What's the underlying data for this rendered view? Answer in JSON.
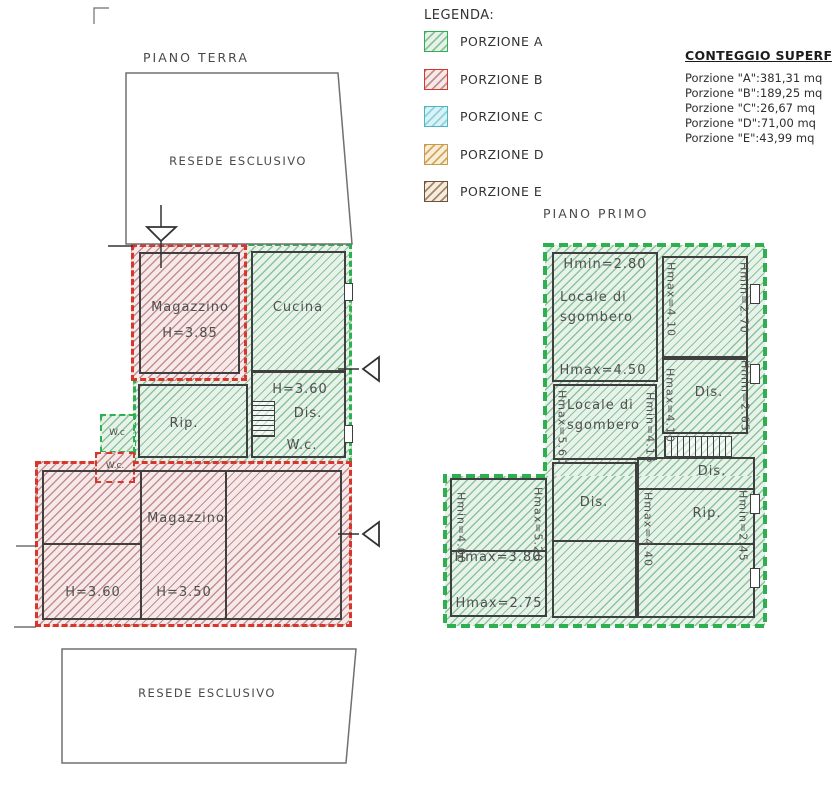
{
  "legend": {
    "title": "LEGENDA:",
    "items": [
      {
        "label": "PORZIONE A",
        "fill": "#e7f3ea",
        "line": "#8cc39a",
        "border": "#2eb050"
      },
      {
        "label": "PORZIONE B",
        "fill": "#f7e9e9",
        "line": "#c28f8f",
        "border": "#d8352b"
      },
      {
        "label": "PORZIONE C",
        "fill": "#daf2f5",
        "line": "#8fd2dc",
        "border": "#49b6c6"
      },
      {
        "label": "PORZIONE D",
        "fill": "#f7edd8",
        "line": "#d3a85c",
        "border": "#c79b4b"
      },
      {
        "label": "PORZIONE E",
        "fill": "#f2ece3",
        "line": "#a8875f",
        "border": "#6e5138"
      }
    ]
  },
  "surfaces": {
    "title": "CONTEGGIO SUPERFICI:",
    "rows": [
      {
        "label": "Porzione \"A\":",
        "value": "381,31 mq"
      },
      {
        "label": "Porzione \"B\":",
        "value": "189,25 mq"
      },
      {
        "label": "Porzione \"C\":",
        "value": "26,67 mq"
      },
      {
        "label": "Porzione \"D\":",
        "value": "71,00 mq"
      },
      {
        "label": "Porzione \"E\":",
        "value": "43,99 mq"
      }
    ]
  },
  "ground_floor": {
    "title": "PIANO TERRA",
    "resede_top": "RESEDE ESCLUSIVO",
    "resede_bottom": "RESEDE ESCLUSIVO",
    "magazzino_top_name": "Magazzino",
    "magazzino_top_h": "H=3.85",
    "cucina": "Cucina",
    "hall_h": "H=3.60",
    "hall_dis": "Dis.",
    "hall_wc": "W.c.",
    "rip": "Rip.",
    "wc_green": "W.c",
    "wc_red": "W.c.",
    "magazzino_bottom": "Magazzino",
    "room_h360": "H=3.60",
    "room_h350": "H=3.50"
  },
  "first_floor": {
    "title": "PIANO PRIMO",
    "locale1_hmin": "Hmin=2.80",
    "locale1_name": "Locale di sgombero",
    "locale1_hmax": "Hmax=4.50",
    "room_ne_left": "Hmax=4.10",
    "room_ne_right": "Hmin=2.70",
    "dis1": "Dis.",
    "dis1_left": "Hmax=4.10",
    "dis1_right": "Hmin=2.65",
    "locale2_name": "Locale di sgombero",
    "locale2_left": "Hmax=5.60",
    "locale2_right": "Hmin=4.15",
    "dis2": "Dis.",
    "rip": "Rip.",
    "rip_left": "Hmax=4.40",
    "rip_right": "Hmin=2.45",
    "sw_left": "Hmin=4.00",
    "sw_right": "Hmax=5.20",
    "sw_mid": "Hmax=3.80",
    "sw_bottom": "Hmax=2.75",
    "dis3": "Dis."
  }
}
